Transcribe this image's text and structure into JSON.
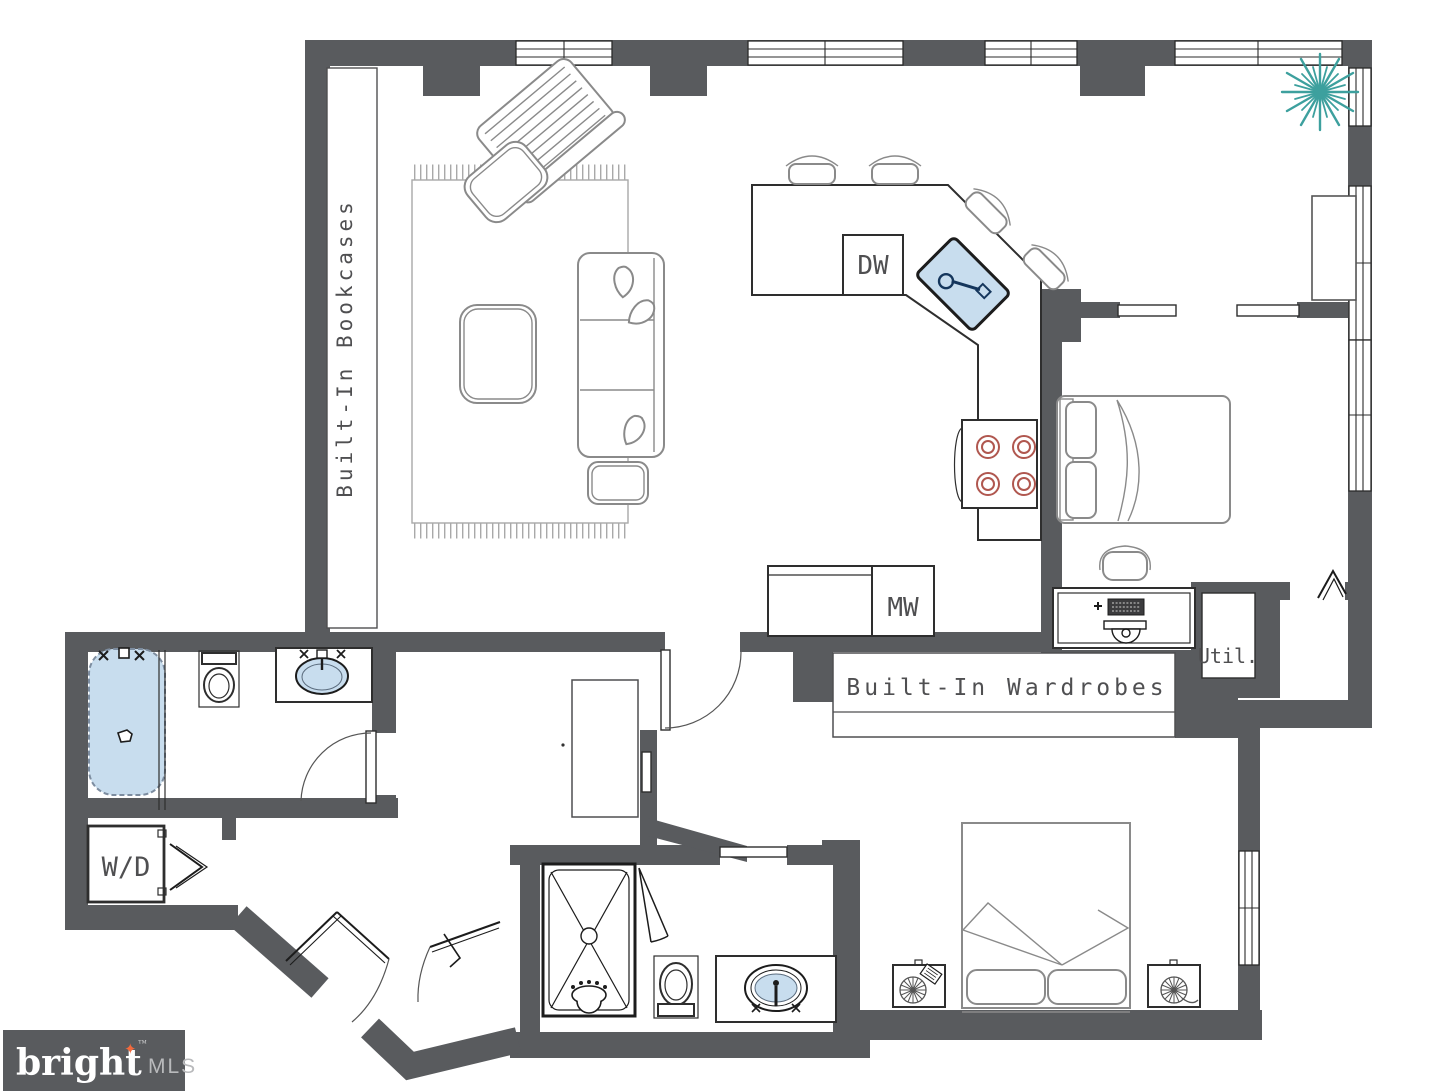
{
  "labels": {
    "bookcases": "Built-In Bookcases",
    "wardrobes": "Built-In Wardrobes",
    "dishwasher": "DW",
    "microwave": "MW",
    "washer_dryer": "W/D",
    "utility": "Util."
  },
  "logo": {
    "brand": "bright",
    "suffix": "MLS",
    "trademark": "™",
    "star": "✦"
  },
  "colors": {
    "wall": "#595b5e",
    "fixture_blue": "#c8ddee",
    "plant_teal": "#3da09e",
    "burner_red": "#b0574f",
    "label_gray": "#4f4f51",
    "furniture_line": "#8a8a8a",
    "fixture_line": "#2e2e2e",
    "logo_bg": "#595b5e",
    "logo_text": "#ffffff",
    "logo_mls": "#b9babc",
    "logo_star": "#f26a3d"
  }
}
